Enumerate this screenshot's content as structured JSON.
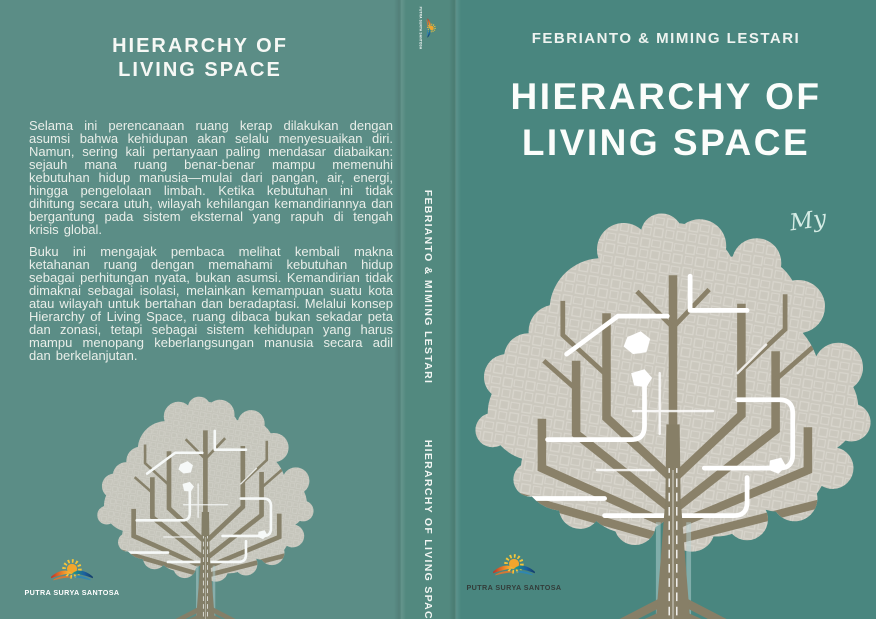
{
  "colors": {
    "cover_teal_front": "#49867f",
    "cover_teal_back": "#5b8d86",
    "cover_teal_spine": "#52897f",
    "title_white": "#fbfdfb",
    "body_text": "#e9eee9",
    "canopy_gray": "#cbc8be",
    "branch_olive": "#8a8169",
    "road_white": "#ffffff",
    "sun_yellow": "#f6c63a",
    "logo_text_dark": "#333d3a"
  },
  "back_cover": {
    "title_line1": "HIERARCHY OF",
    "title_line2": "LIVING SPACE",
    "paragraph1": "Selama ini perencanaan ruang kerap dilakukan dengan asumsi bahwa kehidupan akan selalu menyesuaikan diri. Namun, sering kali pertanyaan paling mendasar diabaikan: sejauh mana ruang benar-benar mampu memenuhi kebutuhan hidup manusia—mulai dari pangan, air, energi, hingga pengelolaan limbah. Ketika kebutuhan ini tidak dihitung secara utuh, wilayah kehilangan kemandiriannya dan bergantung pada sistem eksternal yang rapuh di tengah krisis global.",
    "paragraph2": "Buku ini mengajak pembaca melihat kembali makna ketahanan ruang dengan memahami kebutuhan hidup sebagai perhitungan nyata, bukan asumsi. Kemandirian tidak dimaknai sebagai isolasi, melainkan kemampuan suatu kota atau wilayah untuk bertahan dan beradaptasi. Melalui konsep Hierarchy of Living Space, ruang dibaca bukan sekadar peta dan zonasi, tetapi sebagai sistem kehidupan yang harus mampu menopang keberlangsungan manusia secara adil dan berkelanjutan."
  },
  "spine": {
    "author": "FEBRIANTO & MIMING LESTARI",
    "title": "HIERARCHY OF LIVING SPACE"
  },
  "front_cover": {
    "author": "FEBRIANTO & MIMING LESTARI",
    "title_line1": "HIERARCHY OF",
    "title_line2": "LIVING SPACE",
    "handwritten_note": "My"
  },
  "publisher": {
    "name": "PUTRA SURYA SANTOSA"
  }
}
